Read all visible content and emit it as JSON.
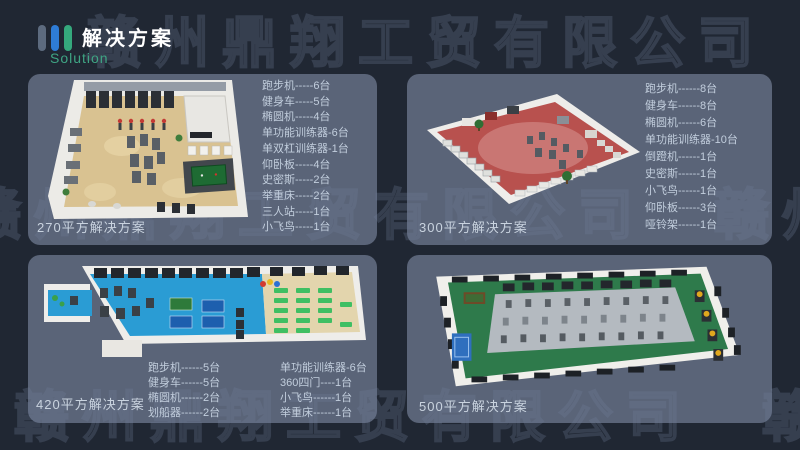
{
  "header": {
    "title": "解决方案",
    "subtitle": "Solution"
  },
  "watermark": {
    "text": "赣州鼎翔工贸有限公司"
  },
  "colors": {
    "background": "#202733",
    "panel": "#5a6478",
    "accent_blue": "#2e7cd6",
    "accent_green": "#35a97d",
    "subtitle_green": "#3fa584",
    "floor_beige": "#d9c291",
    "floor_red": "#b8514e",
    "floor_blue": "#2a9cd4",
    "floor_green": "#2e7a4b"
  },
  "solutions": [
    {
      "caption": "270平方解决方案",
      "equipment": [
        "跑步机-----6台",
        "健身车-----5台",
        "椭圆机-----4台",
        "单功能训练器-6台",
        "单双杠训练器-1台",
        "仰卧板-----4台",
        "史密斯-----2台",
        "举重床-----2台",
        "三人站-----1台",
        "小飞鸟-----1台"
      ]
    },
    {
      "caption": "300平方解决方案",
      "equipment": [
        "跑步机------8台",
        "健身车------8台",
        "椭圆机------6台",
        "单功能训练器-10台",
        "倒蹬机------1台",
        "史密斯------1台",
        "小飞鸟------1台",
        "仰卧板------3台",
        "哑铃架------1台"
      ]
    },
    {
      "caption": "420平方解决方案",
      "equipment_col1": [
        "跑步机------5台",
        "健身车------5台",
        "椭圆机------2台",
        "划船器------2台"
      ],
      "equipment_col2": [
        "单功能训练器-6台",
        "360四门----1台",
        "小飞鸟------1台",
        "举重床------1台"
      ]
    },
    {
      "caption": "500平方解决方案",
      "equipment": []
    }
  ]
}
